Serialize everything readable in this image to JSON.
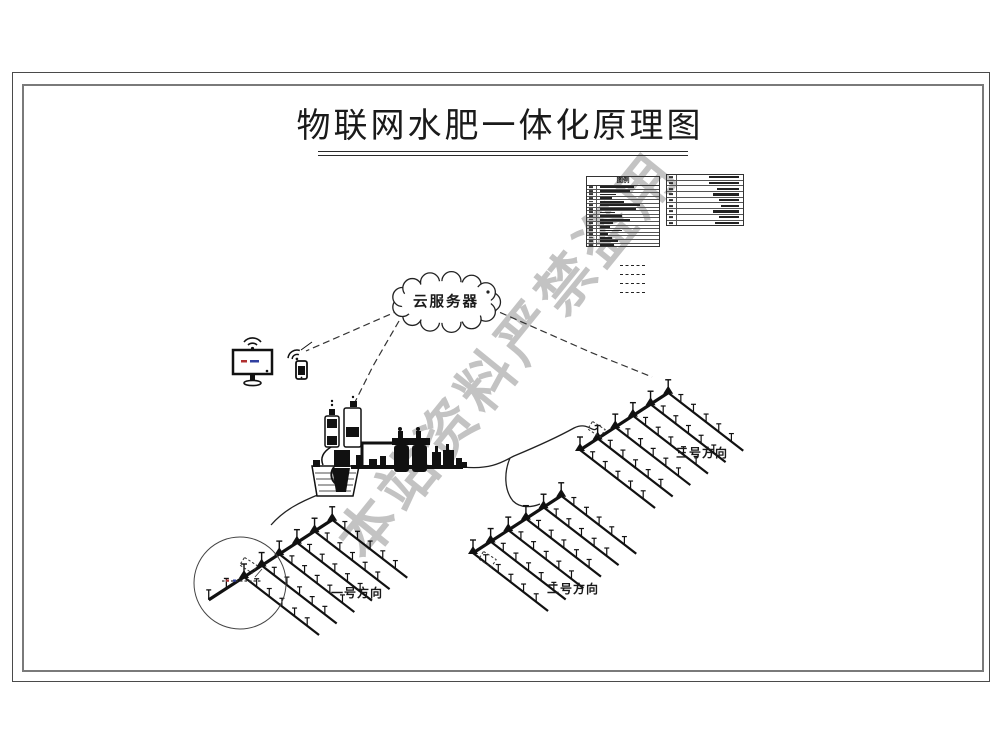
{
  "title": "物联网水肥一体化原理图",
  "watermark": "本站资料严禁盗用",
  "cloud": {
    "label": "云服务器"
  },
  "legend": {
    "left_table": {
      "title": "图例",
      "row_count": 17
    },
    "right_table": {
      "row_count": 9
    },
    "dashed_line_sample_count": 4
  },
  "fields": [
    {
      "id": "field-1",
      "label": "一号方向"
    },
    {
      "id": "field-2",
      "label": "二号方向"
    },
    {
      "id": "field-3",
      "label": "三号方向"
    }
  ],
  "colors": {
    "ink": "#1a1a1a",
    "frame_outer": "#4a4a4a",
    "frame_inner": "#7a7a7a",
    "watermark_gray": "#828282",
    "screen_mark_red": "#b03030",
    "screen_mark_blue": "#3040a0"
  }
}
